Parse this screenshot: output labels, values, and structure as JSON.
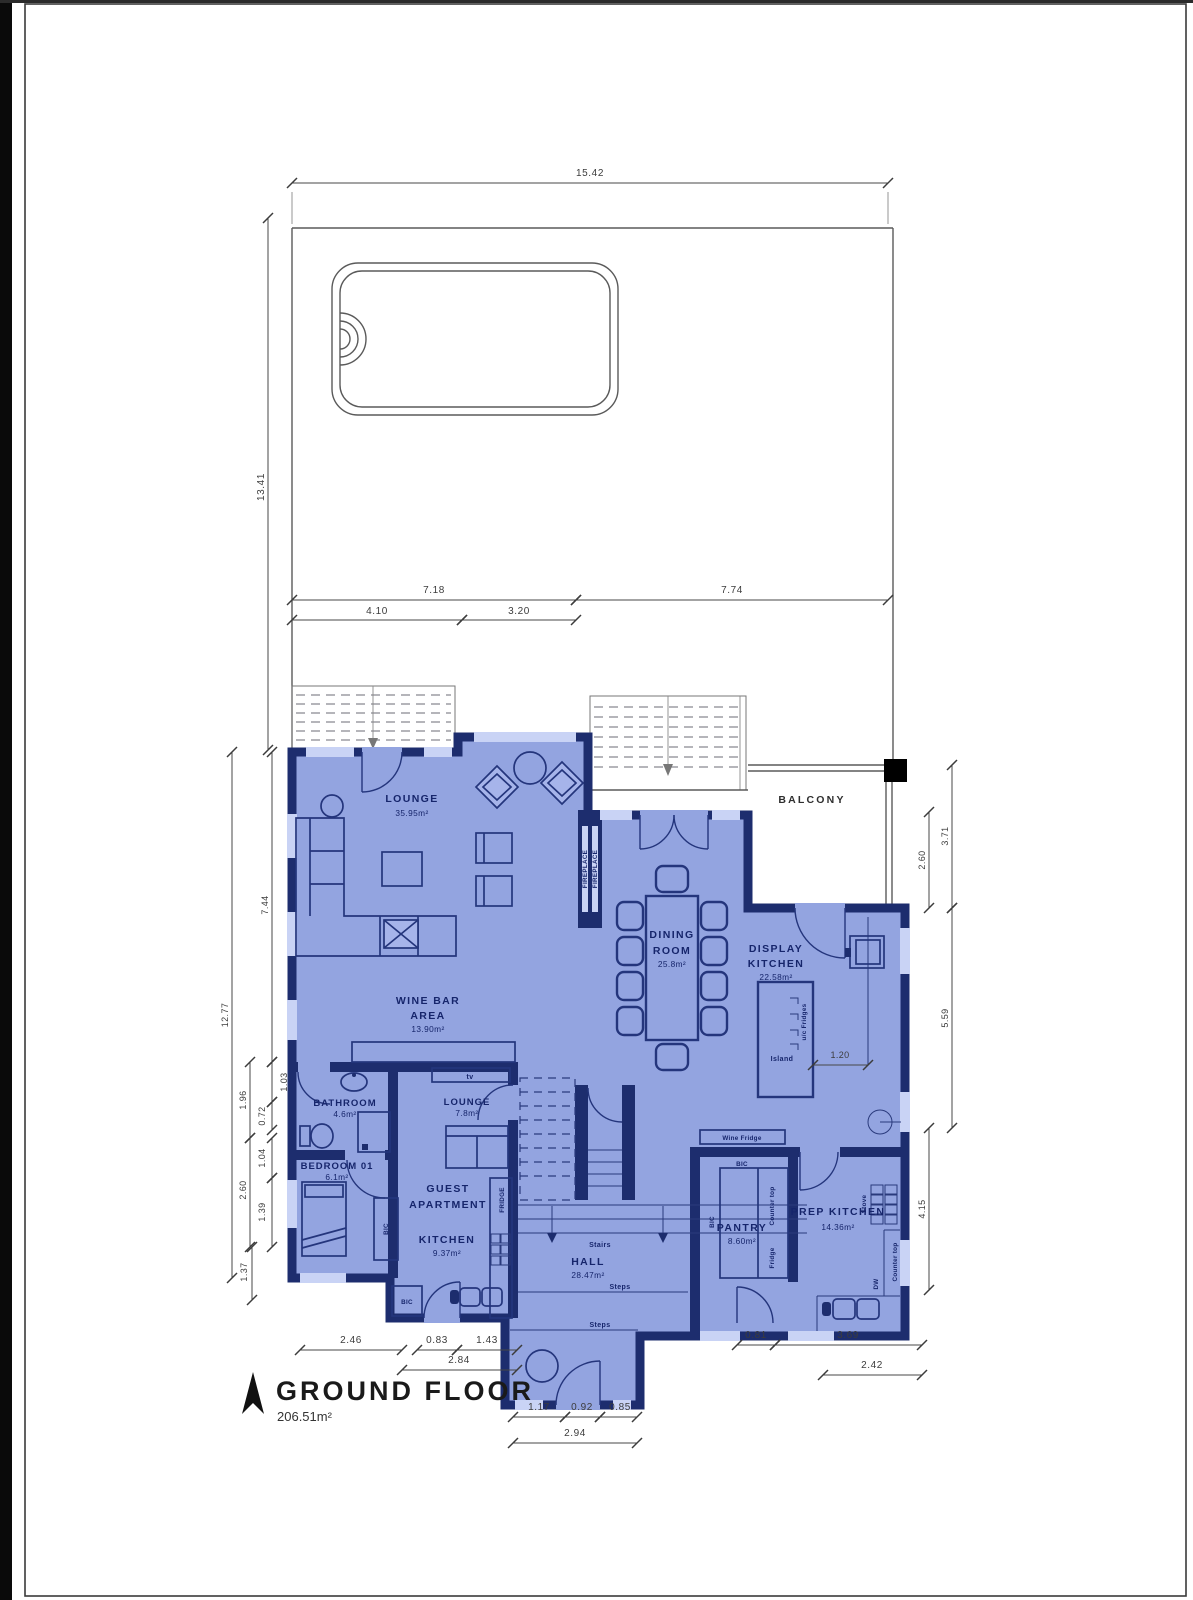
{
  "page": {
    "title": "GROUND FLOOR",
    "total_area": "206.51m²"
  },
  "rooms": {
    "lounge": {
      "name": "LOUNGE",
      "area": "35.95m²"
    },
    "wine_bar": {
      "line1": "WINE BAR",
      "line2": "AREA",
      "area": "13.90m²"
    },
    "dining": {
      "line1": "DINING",
      "line2": "ROOM",
      "area": "25.8m²"
    },
    "display_kitchen": {
      "line1": "DISPLAY",
      "line2": "KITCHEN",
      "area": "22.58m²"
    },
    "balcony": {
      "name": "BALCONY"
    },
    "bathroom": {
      "name": "BATHROOM",
      "area": "4.6m²"
    },
    "guest_lounge": {
      "name": "LOUNGE",
      "area": "7.8m²"
    },
    "bedroom": {
      "name": "BEDROOM 01",
      "area": "6.1m²"
    },
    "guest_apartment": {
      "line1": "GUEST",
      "line2": "APARTMENT"
    },
    "guest_kitchen": {
      "name": "KITCHEN",
      "area": "9.37m²"
    },
    "hall": {
      "name": "HALL",
      "area": "28.47m²"
    },
    "pantry": {
      "name": "PANTRY",
      "area": "8.60m²"
    },
    "prep_kitchen": {
      "name": "PREP KITCHEN",
      "area": "14.36m²"
    }
  },
  "fixtures": {
    "fireplace": "FIREPLACE",
    "tv": "tv",
    "bic": "BIC",
    "fridge_caps": "FRIDGE",
    "fridge": "Fridge",
    "wine_fridge": "Wine Fridge",
    "counter_top": "Counter top",
    "stove": "Stove",
    "dw": "DW",
    "island": "Island",
    "uc_fridges": "u/c Fridges",
    "stairs": "Stairs",
    "steps": "Steps"
  },
  "dims": {
    "site_w": "15.42",
    "site_h": "13.41",
    "mid": [
      "7.18",
      "7.74",
      "4.10",
      "3.20"
    ],
    "left": [
      "7.44",
      "12.77",
      "1.96",
      "1.03",
      "0.72",
      "1.04",
      "2.60",
      "1.39",
      "1.37"
    ],
    "right": [
      "3.71",
      "2.60",
      "5.59",
      "4.15"
    ],
    "island": "1.20",
    "bottom_left": [
      "2.46",
      "0.83",
      "1.43",
      "2.84"
    ],
    "entry": [
      "1.17",
      "0.92",
      "0.85",
      "2.94"
    ],
    "bottom_right": [
      "0.81",
      "3.69",
      "2.42"
    ]
  },
  "colors": {
    "wall": "#1d2d6e",
    "floor": "#93a4e0",
    "window": "#c9d3f5"
  }
}
